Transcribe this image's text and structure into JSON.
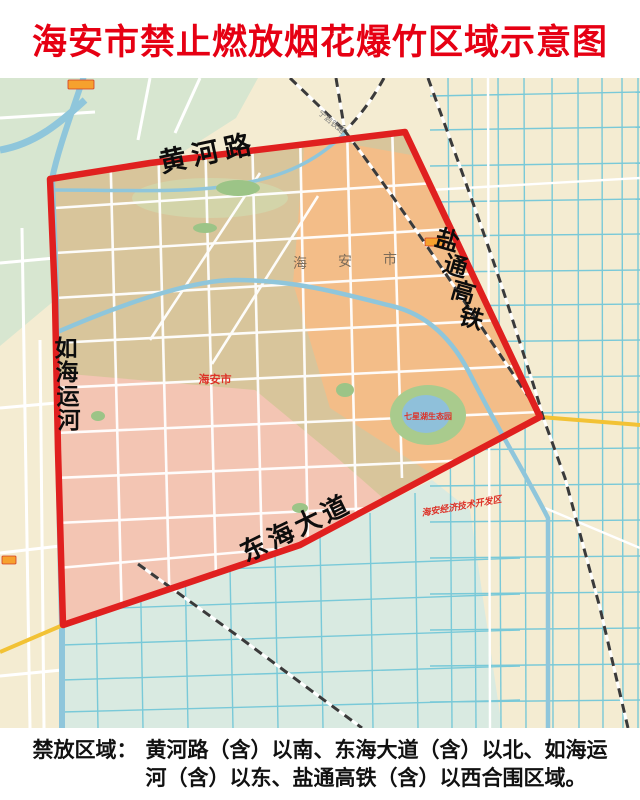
{
  "title": "海安市禁止燃放烟花爆竹区域示意图",
  "colors": {
    "title_red": "#e60013",
    "boundary_red": "#e0201f",
    "zone_tan": "#d8c59b",
    "zone_orange": "#f3bd88",
    "zone_pink": "#f3c5b3",
    "zone_green_nw": "#d7e6d0",
    "zone_teal_south": "#d9eae1",
    "base_cream": "#f4ecd2",
    "water_blue": "#8fc6db",
    "road_cyan": "#79c9d8",
    "road_yellow": "#f2c235"
  },
  "map": {
    "road_labels": {
      "north": "黄河路",
      "south": "东海大道",
      "east_chars": [
        "盐",
        "通",
        "高",
        "铁"
      ],
      "west_chars": [
        "如",
        "海",
        "运",
        "河"
      ]
    },
    "place_labels": {
      "city": "海安市",
      "city_watermark_chars": [
        "海",
        "安",
        "市"
      ],
      "park": "七星湖生态园",
      "dev_zone": "海安经济技术开发区",
      "railway": "宁启铁路"
    }
  },
  "note": {
    "label": "禁放区域：",
    "text": "黄河路（含）以南、东海大道（含）以北、如海运河（含）以东、盐通高铁（含）以西合围区域。"
  }
}
